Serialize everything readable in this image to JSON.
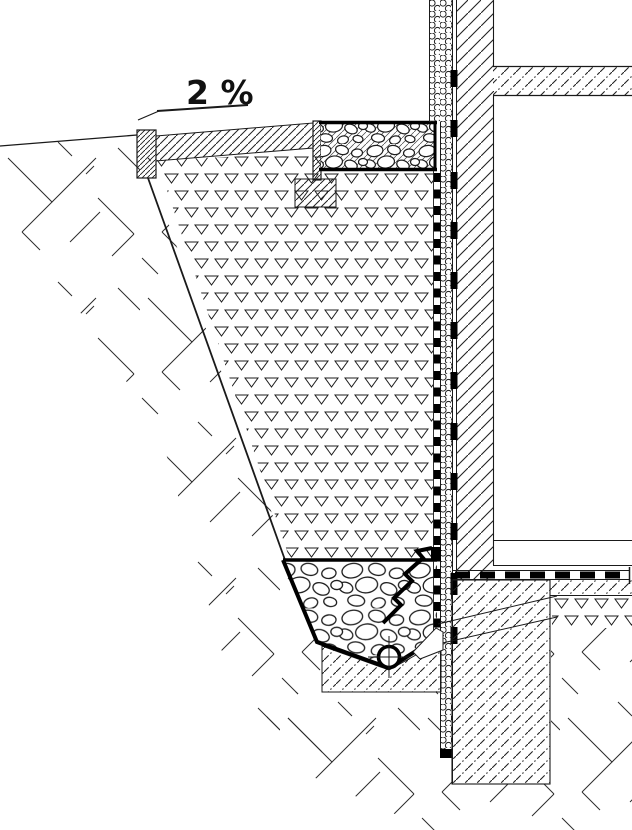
{
  "annotations": {
    "slope_label": "2 %"
  },
  "colors": {
    "line": "#1a1a1a",
    "background": "#ffffff",
    "fastener": "#000000"
  }
}
